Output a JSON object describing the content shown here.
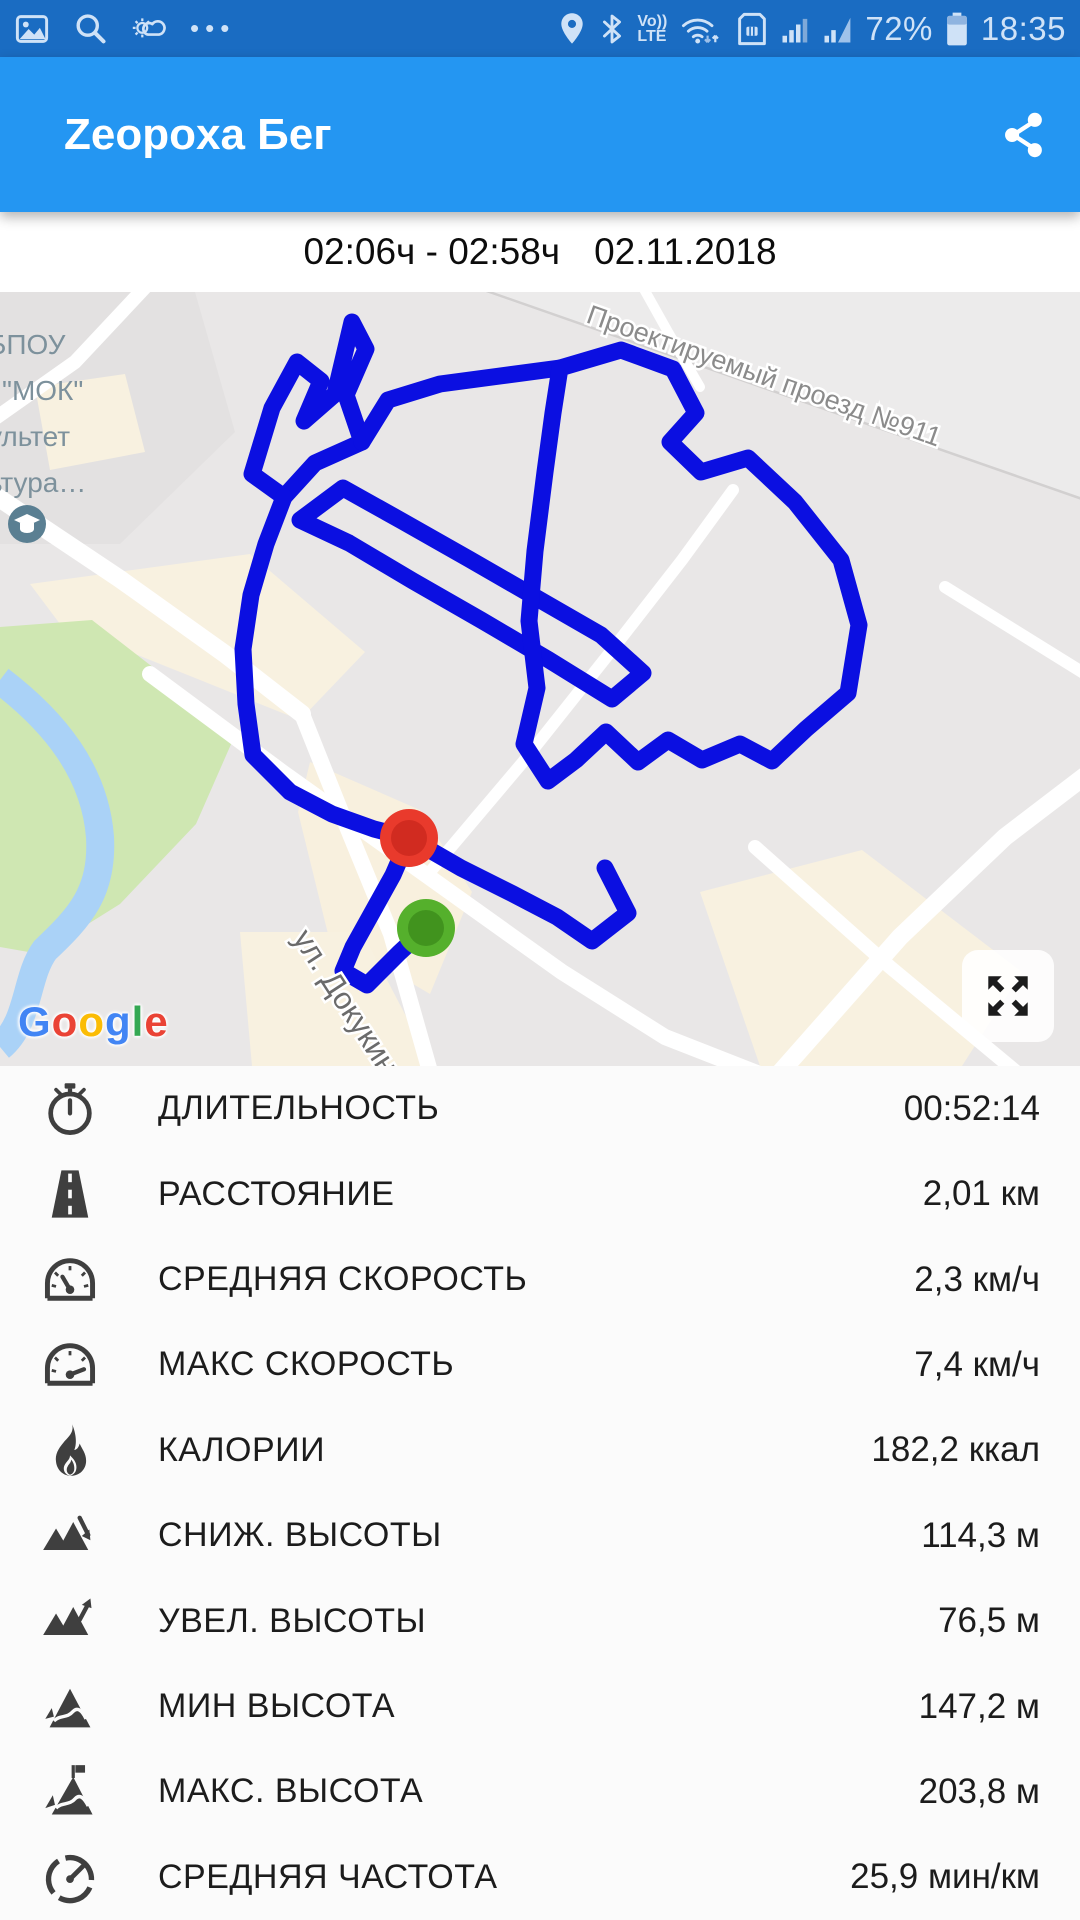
{
  "status_bar": {
    "more_icon": "•••",
    "volte_line1": "Vo))",
    "volte_line2": "LTE",
    "battery_percent": "72%",
    "time": "18:35"
  },
  "app_bar": {
    "title": "Zeopoxa Бег"
  },
  "summary_bar": {
    "time_range": "02:06ч - 02:58ч",
    "date": "02.11.2018"
  },
  "map": {
    "poi_line1": "БПОУ",
    "poi_line2": "\"МОК\"",
    "poi_line3": "ультет",
    "poi_line4": "ьтура…",
    "street_label_1": "Проектируемый проезд №911",
    "street_label_2": "ул. Докукина",
    "attribution": "Google",
    "route_color": "#0b0fe1",
    "start_marker_color": "#55b02c",
    "end_marker_color": "#e93a2c"
  },
  "stats": {
    "rows": [
      {
        "icon": "stopwatch-icon",
        "label": "ДЛИТЕЛЬНОСТЬ",
        "value": "00:52:14"
      },
      {
        "icon": "road-icon",
        "label": "РАССТОЯНИЕ",
        "value": "2,01 км"
      },
      {
        "icon": "speedometer-icon",
        "label": "СРЕДНЯЯ СКОРОСТЬ",
        "value": "2,3 км/ч"
      },
      {
        "icon": "speedometer-max-icon",
        "label": "МАКС СКОРОСТЬ",
        "value": "7,4 км/ч"
      },
      {
        "icon": "flame-icon",
        "label": "КАЛОРИИ",
        "value": "182,2 ккал"
      },
      {
        "icon": "mountain-descent-icon",
        "label": "СНИЖ. ВЫСОТЫ",
        "value": "114,3 м"
      },
      {
        "icon": "mountain-ascent-icon",
        "label": "УВЕЛ. ВЫСОТЫ",
        "value": "76,5 м"
      },
      {
        "icon": "mountain-min-icon",
        "label": "МИН ВЫСОТА",
        "value": "147,2 м"
      },
      {
        "icon": "mountain-flag-icon",
        "label": "МАКС. ВЫСОТА",
        "value": "203,8 м"
      },
      {
        "icon": "pace-gauge-icon",
        "label": "СРЕДНЯЯ ЧАСТОТА",
        "value": "25,9 мин/км"
      }
    ]
  }
}
